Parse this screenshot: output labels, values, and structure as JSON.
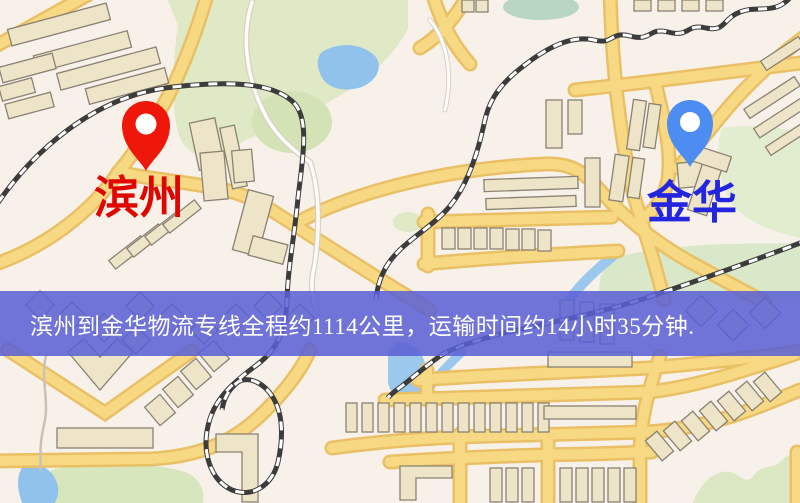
{
  "banner": {
    "text": "滨州到金华物流专线全程约1114公里，运输时间约14小时35分钟.",
    "bg_color": "#5a5fd5",
    "text_color": "#ffffff"
  },
  "origin": {
    "label": "滨州",
    "label_color": "#df0600",
    "pin_icon": "red-map-pin",
    "pin_color": "#ee170a"
  },
  "destination": {
    "label": "金华",
    "label_color": "#2425de",
    "pin_icon": "blue-map-pin",
    "pin_color": "#4d8df2"
  },
  "route_info": {
    "distance_text": "约1114公里",
    "duration_text": "约14小时35分钟"
  },
  "map_colors": {
    "background": "#f8f1ea",
    "road_fill": "#f8d983",
    "road_casing": "#e9c065",
    "minor_road": "#fdfcf8",
    "building_fill": "#eee5c9",
    "building_outline": "#8a8273",
    "park_green": "#dfe9c6",
    "water_blue": "#90c2ec",
    "railway_dark": "#3c3c3c"
  }
}
